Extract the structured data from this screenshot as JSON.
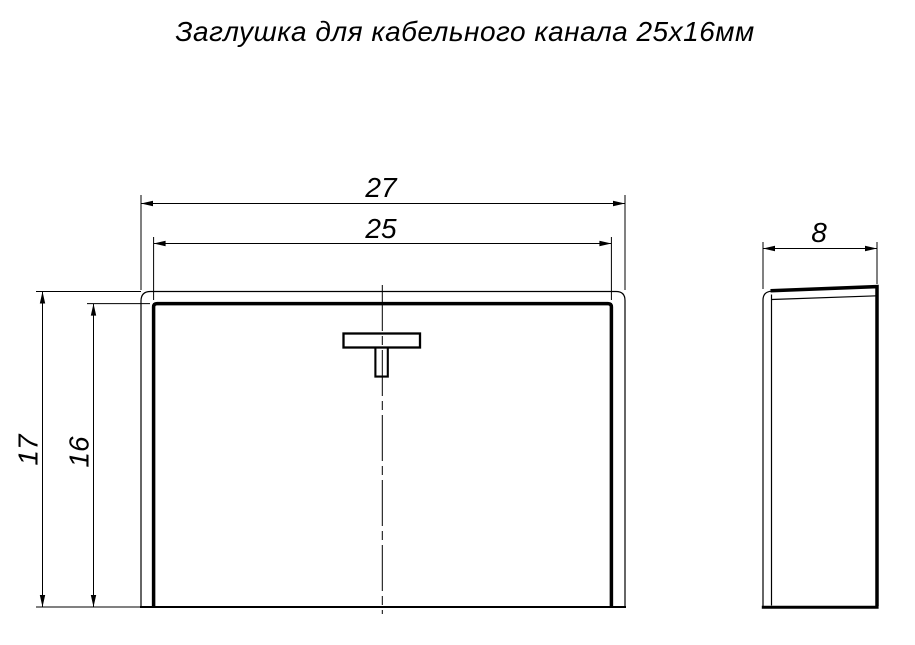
{
  "title": "Заглушка для кабельного канала 25х16мм",
  "part": {
    "name_ru": "Заглушка для кабельного канала",
    "size_label": "25х16мм"
  },
  "colors": {
    "line": "#000000",
    "background": "#ffffff"
  },
  "views": {
    "front": {
      "label": "front-view"
    },
    "side": {
      "label": "side-view"
    }
  },
  "dimensions": {
    "outer_width": "27",
    "inner_width": "25",
    "outer_height": "17",
    "inner_height": "16",
    "depth": "8"
  }
}
